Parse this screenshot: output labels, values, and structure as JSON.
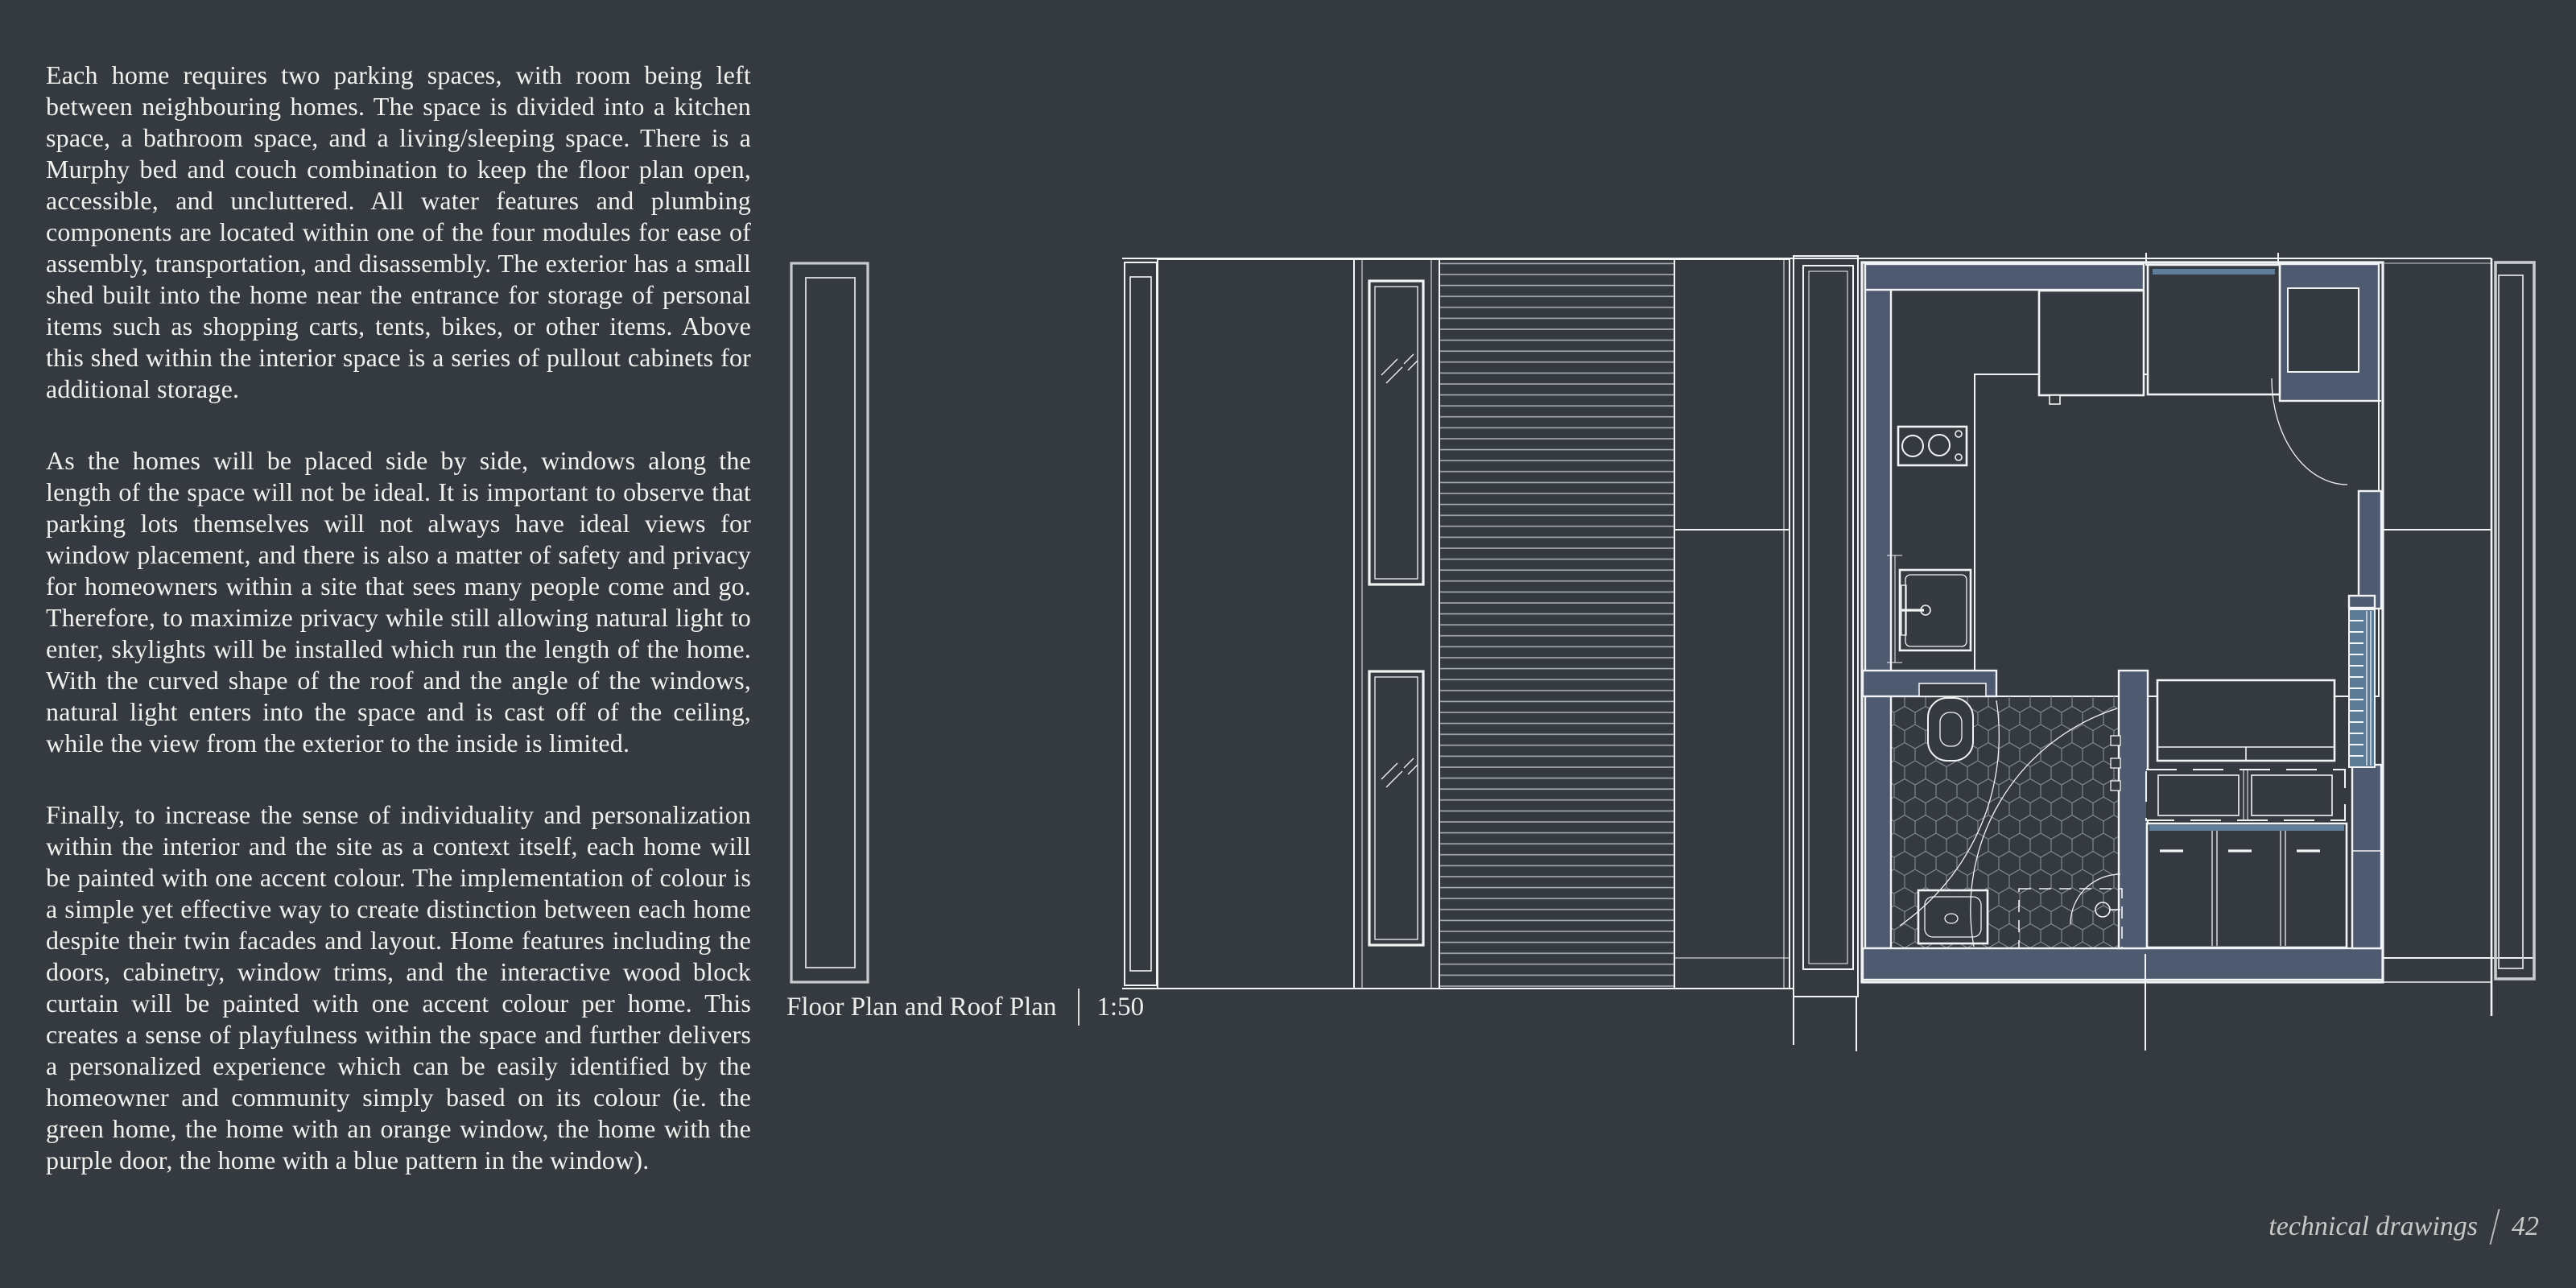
{
  "page": {
    "background": "#343A40",
    "footer": {
      "label": "technical drawings",
      "separator": "|",
      "page_number": "42"
    }
  },
  "article": {
    "paragraphs": [
      "Each home requires two parking spaces, with room being left between neighbouring homes. The space is divided into a kitchen space, a bathroom space, and a living/sleeping space. There is a Murphy bed and couch combination to keep the floor plan open, accessible, and uncluttered. All water features and plumbing components are located within one of the four modules for ease of assembly, transportation, and disassembly. The exterior has a small shed built into the home near the entrance for storage of personal items such as shopping carts, tents, bikes, or other items. Above this shed within the interior space is a series of pullout cabinets for additional storage.",
      "As the homes will be placed side by side, windows along the length of the space will not be ideal. It is important to observe that parking lots themselves will not always have ideal views for window placement, and there is also a matter of safety and privacy for homeowners within a site that sees many people come and go. Therefore, to maximize privacy while still allowing natural light to enter, skylights will be installed which run the length of the home. With the curved shape of the roof and the angle of the windows, natural light enters into the space and is cast off of the ceiling, while the view from the exterior to the inside is limited.",
      "Finally, to increase the sense of individuality and personalization within the interior and the site as a context itself, each home will be painted with one accent colour. The implementation of colour is a simple yet effective way to create distinction between each home despite their twin facades and layout. Home features including the doors, cabinetry, window trims, and the interactive wood block curtain will be painted with one accent colour per home. This creates a sense of playfulness within the space and further delivers a personalized experience which can be easily identified by the homeowner and community simply based on its colour (ie. the green home, the home with an orange window, the home with the purple door, the home with a blue pattern in the window)."
    ]
  },
  "drawing": {
    "caption": {
      "title": "Floor Plan and Roof Plan",
      "separator": "|",
      "scale": "1:50"
    },
    "colors": {
      "bg": "#343A40",
      "line": "#F2F3F4",
      "muted_line": "#C9CCCE",
      "hatch": "#7F868D",
      "deck_line": "#A9AEB3",
      "wall": "#4E5A70",
      "window_blue": "#5B7A96",
      "cabinet_band": "#5E7D9B",
      "text": "#F2F1EE",
      "caption_text": "#EDEDEB",
      "footer_text": "#C9C8C6"
    }
  }
}
